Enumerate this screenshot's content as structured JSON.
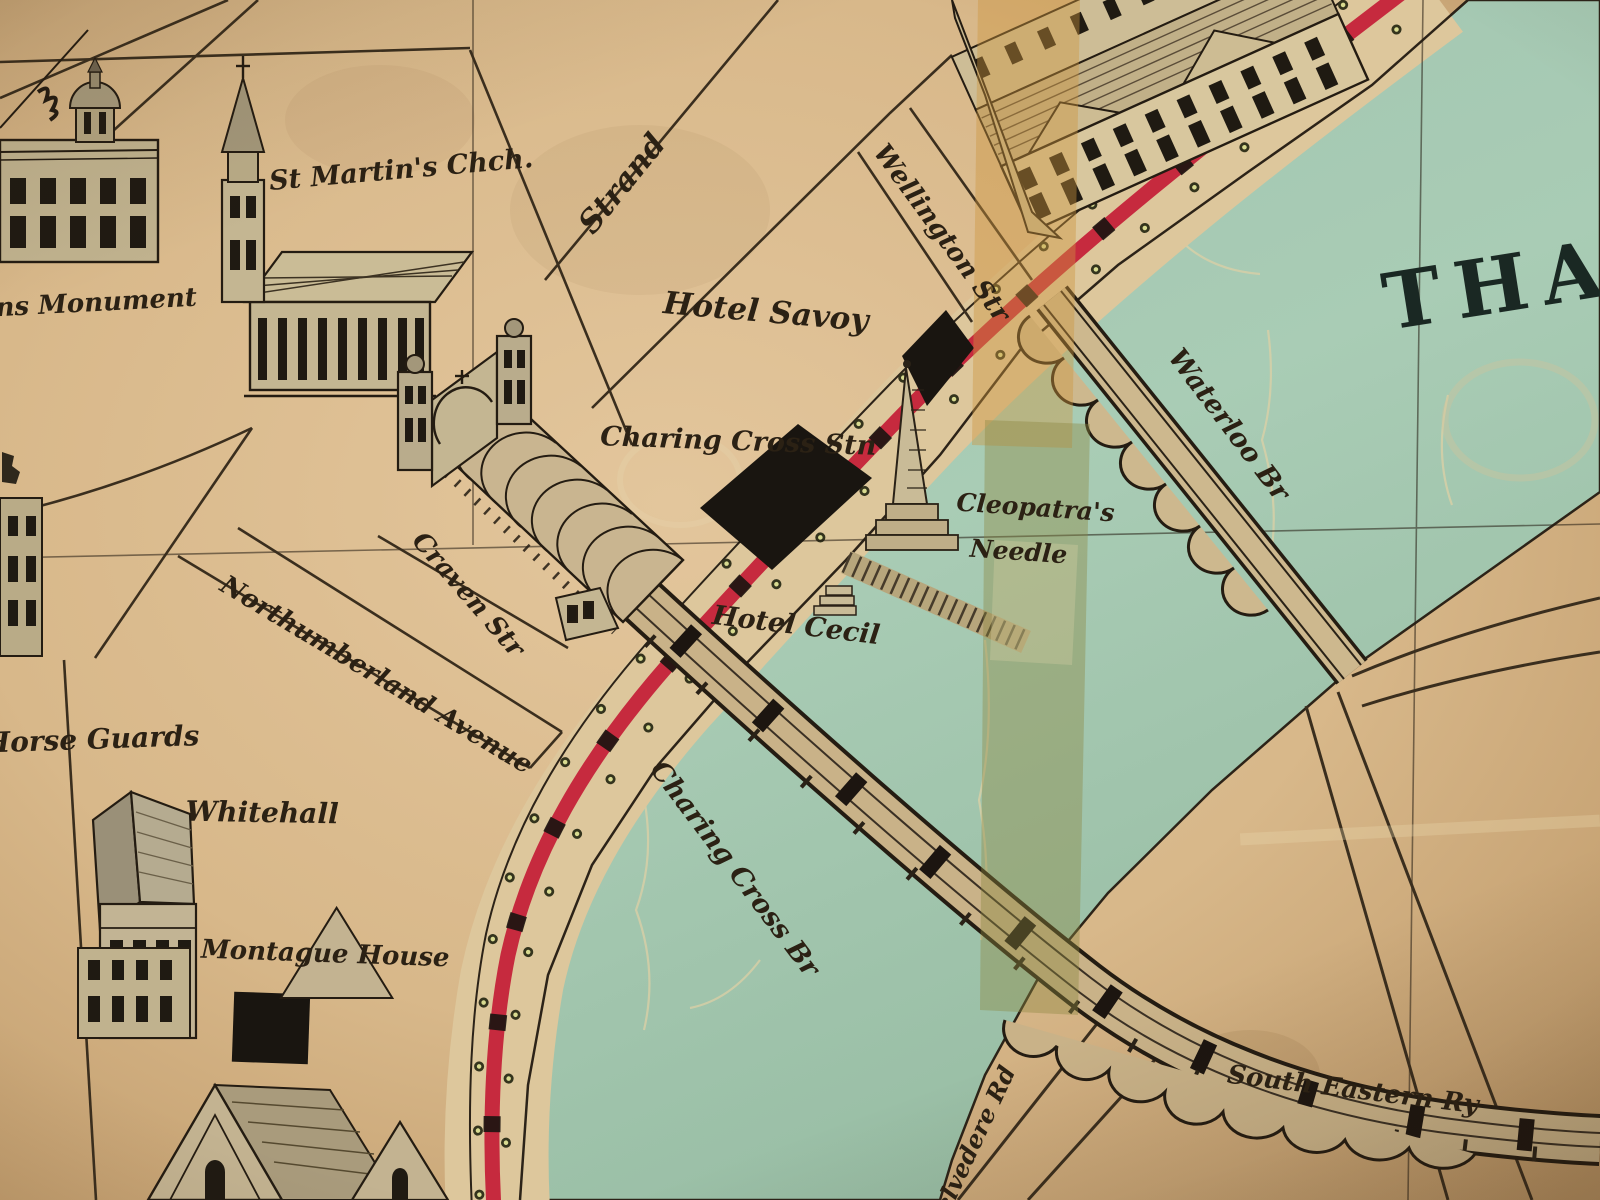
{
  "map": {
    "description": "Antique pictorial map photograph of London around Charing Cross and the Thames",
    "labels": {
      "monument": "ns Monument",
      "st_martins": "St Martin's Chch.",
      "strand": "Strand",
      "wellington_st": "Wellington Str",
      "hotel_savoy": "Hotel Savoy",
      "charing_cross_stn": "Charing Cross Stn",
      "hotel_cecil": "Hotel Cecil",
      "cleopatras_line1": "Cleopatra's",
      "cleopatras_line2": "Needle",
      "waterloo_br": "Waterloo Br",
      "thames_fragment": "THA",
      "craven_st": "Craven Str",
      "northumberland_ave": "Northumberland Avenue",
      "horse_guards": "Horse Guards",
      "whitehall": "Whitehall",
      "montague_house": "Montague House",
      "charing_cross_br": "Charing Cross Br",
      "south_eastern_ry": "South Eastern Ry",
      "belvedere_rd": "Belvedere Rd"
    },
    "colors": {
      "paper": "#d9b98c",
      "river": "#a5c7b1",
      "railway_red": "#c62a3e",
      "ink": "#2b2114",
      "tape_repair": "#c09a54",
      "building_fill": "#c4b692",
      "black_blocks": "#191510"
    }
  }
}
